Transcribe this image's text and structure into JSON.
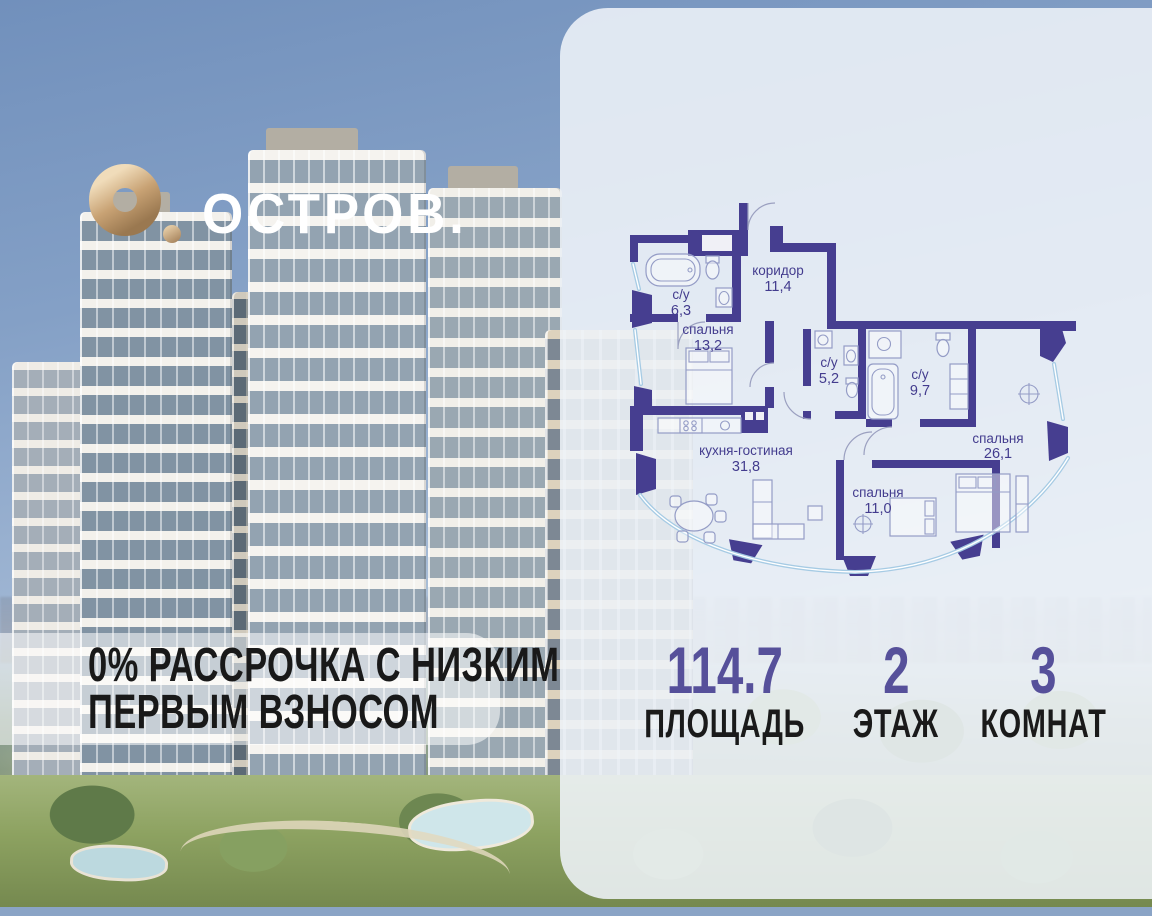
{
  "logo": {
    "brand": "ОСТРОВ."
  },
  "promo_banner": {
    "line1": "0% РАССРОЧКА С НИЗКИМ",
    "line2": "ПЕРВЫМ ВЗНОСОМ"
  },
  "floor_plan": {
    "rooms": [
      {
        "name": "с/у",
        "area": "6,3"
      },
      {
        "name": "коридор",
        "area": "11,4"
      },
      {
        "name": "спальня",
        "area": "13,2"
      },
      {
        "name": "с/у",
        "area": "5,2"
      },
      {
        "name": "с/у",
        "area": "9,7"
      },
      {
        "name": "кухня-гостиная",
        "area": "31,8"
      },
      {
        "name": "спальня",
        "area": "11,0"
      },
      {
        "name": "спальня",
        "area": "26,1"
      }
    ]
  },
  "stats": {
    "items": [
      {
        "value": "114.7",
        "label": "ПЛОЩАДЬ"
      },
      {
        "value": "2",
        "label": "ЭТАЖ"
      },
      {
        "value": "3",
        "label": "КОМНАТ"
      }
    ]
  },
  "colors": {
    "accent_purple": "#56509A",
    "plan_wall_purple": "#463E90",
    "logo_gold": "#C8A274",
    "card_background": "#EAEFF6",
    "glazing_blue": "#A6CBE4",
    "banner_text": "#191919"
  }
}
